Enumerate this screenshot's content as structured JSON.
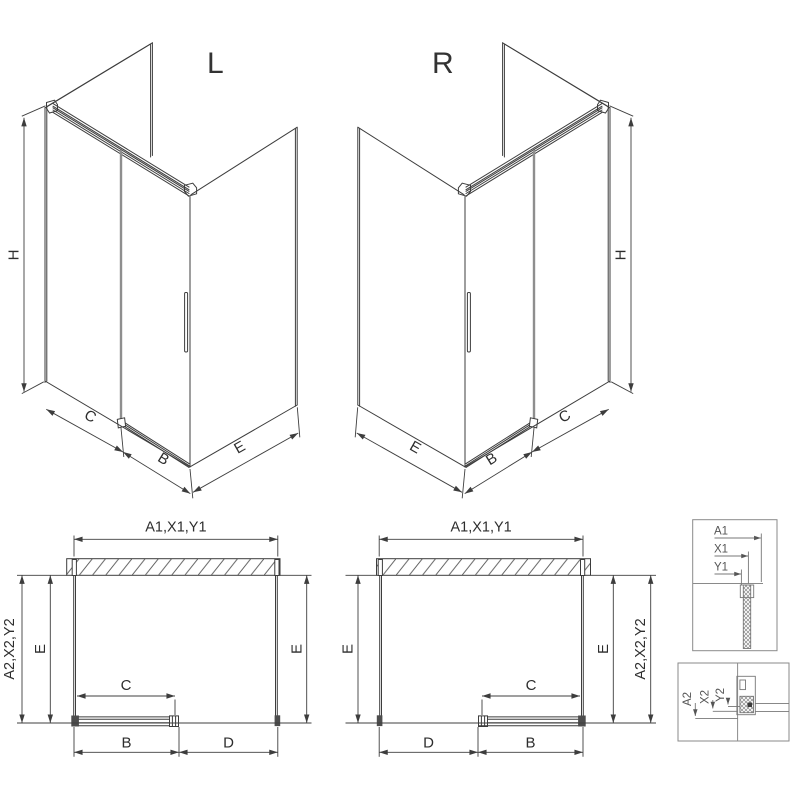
{
  "drawing": {
    "title_hint": "shower-enclosure-technical-drawing",
    "iso_left": {
      "variant_label": "L",
      "height_label": "H",
      "fixed_width_label": "C",
      "door_width_label": "B",
      "side_depth_label": "E"
    },
    "iso_right": {
      "variant_label": "R",
      "height_label": "H",
      "fixed_width_label": "C",
      "door_width_label": "B",
      "side_depth_label": "E"
    },
    "plan_left": {
      "total_width_label": "A1,X1,Y1",
      "total_width_alt_label": "A2,X2,Y2",
      "side_left_label": "E",
      "side_right_label": "E",
      "opening_label": "C",
      "door_label": "B",
      "fixed_label": "D"
    },
    "plan_right": {
      "total_width_label": "A1,X1,Y1",
      "total_width_alt_label": "A2,X2,Y2",
      "side_left_label": "E",
      "side_right_label": "E",
      "opening_label": "C",
      "door_label": "B",
      "fixed_label": "D"
    },
    "detail_top": {
      "label_a1": "A1",
      "label_x1": "X1",
      "label_y1": "Y1"
    },
    "detail_bottom": {
      "label_a2": "A2",
      "label_x2": "X2",
      "label_y2": "Y2"
    },
    "colors": {
      "line": "#3d3d3d",
      "dim": "#3f3f3f",
      "door_profile": "#8e8e8e",
      "detail": "#777777",
      "box": "#8a8a8a"
    }
  }
}
